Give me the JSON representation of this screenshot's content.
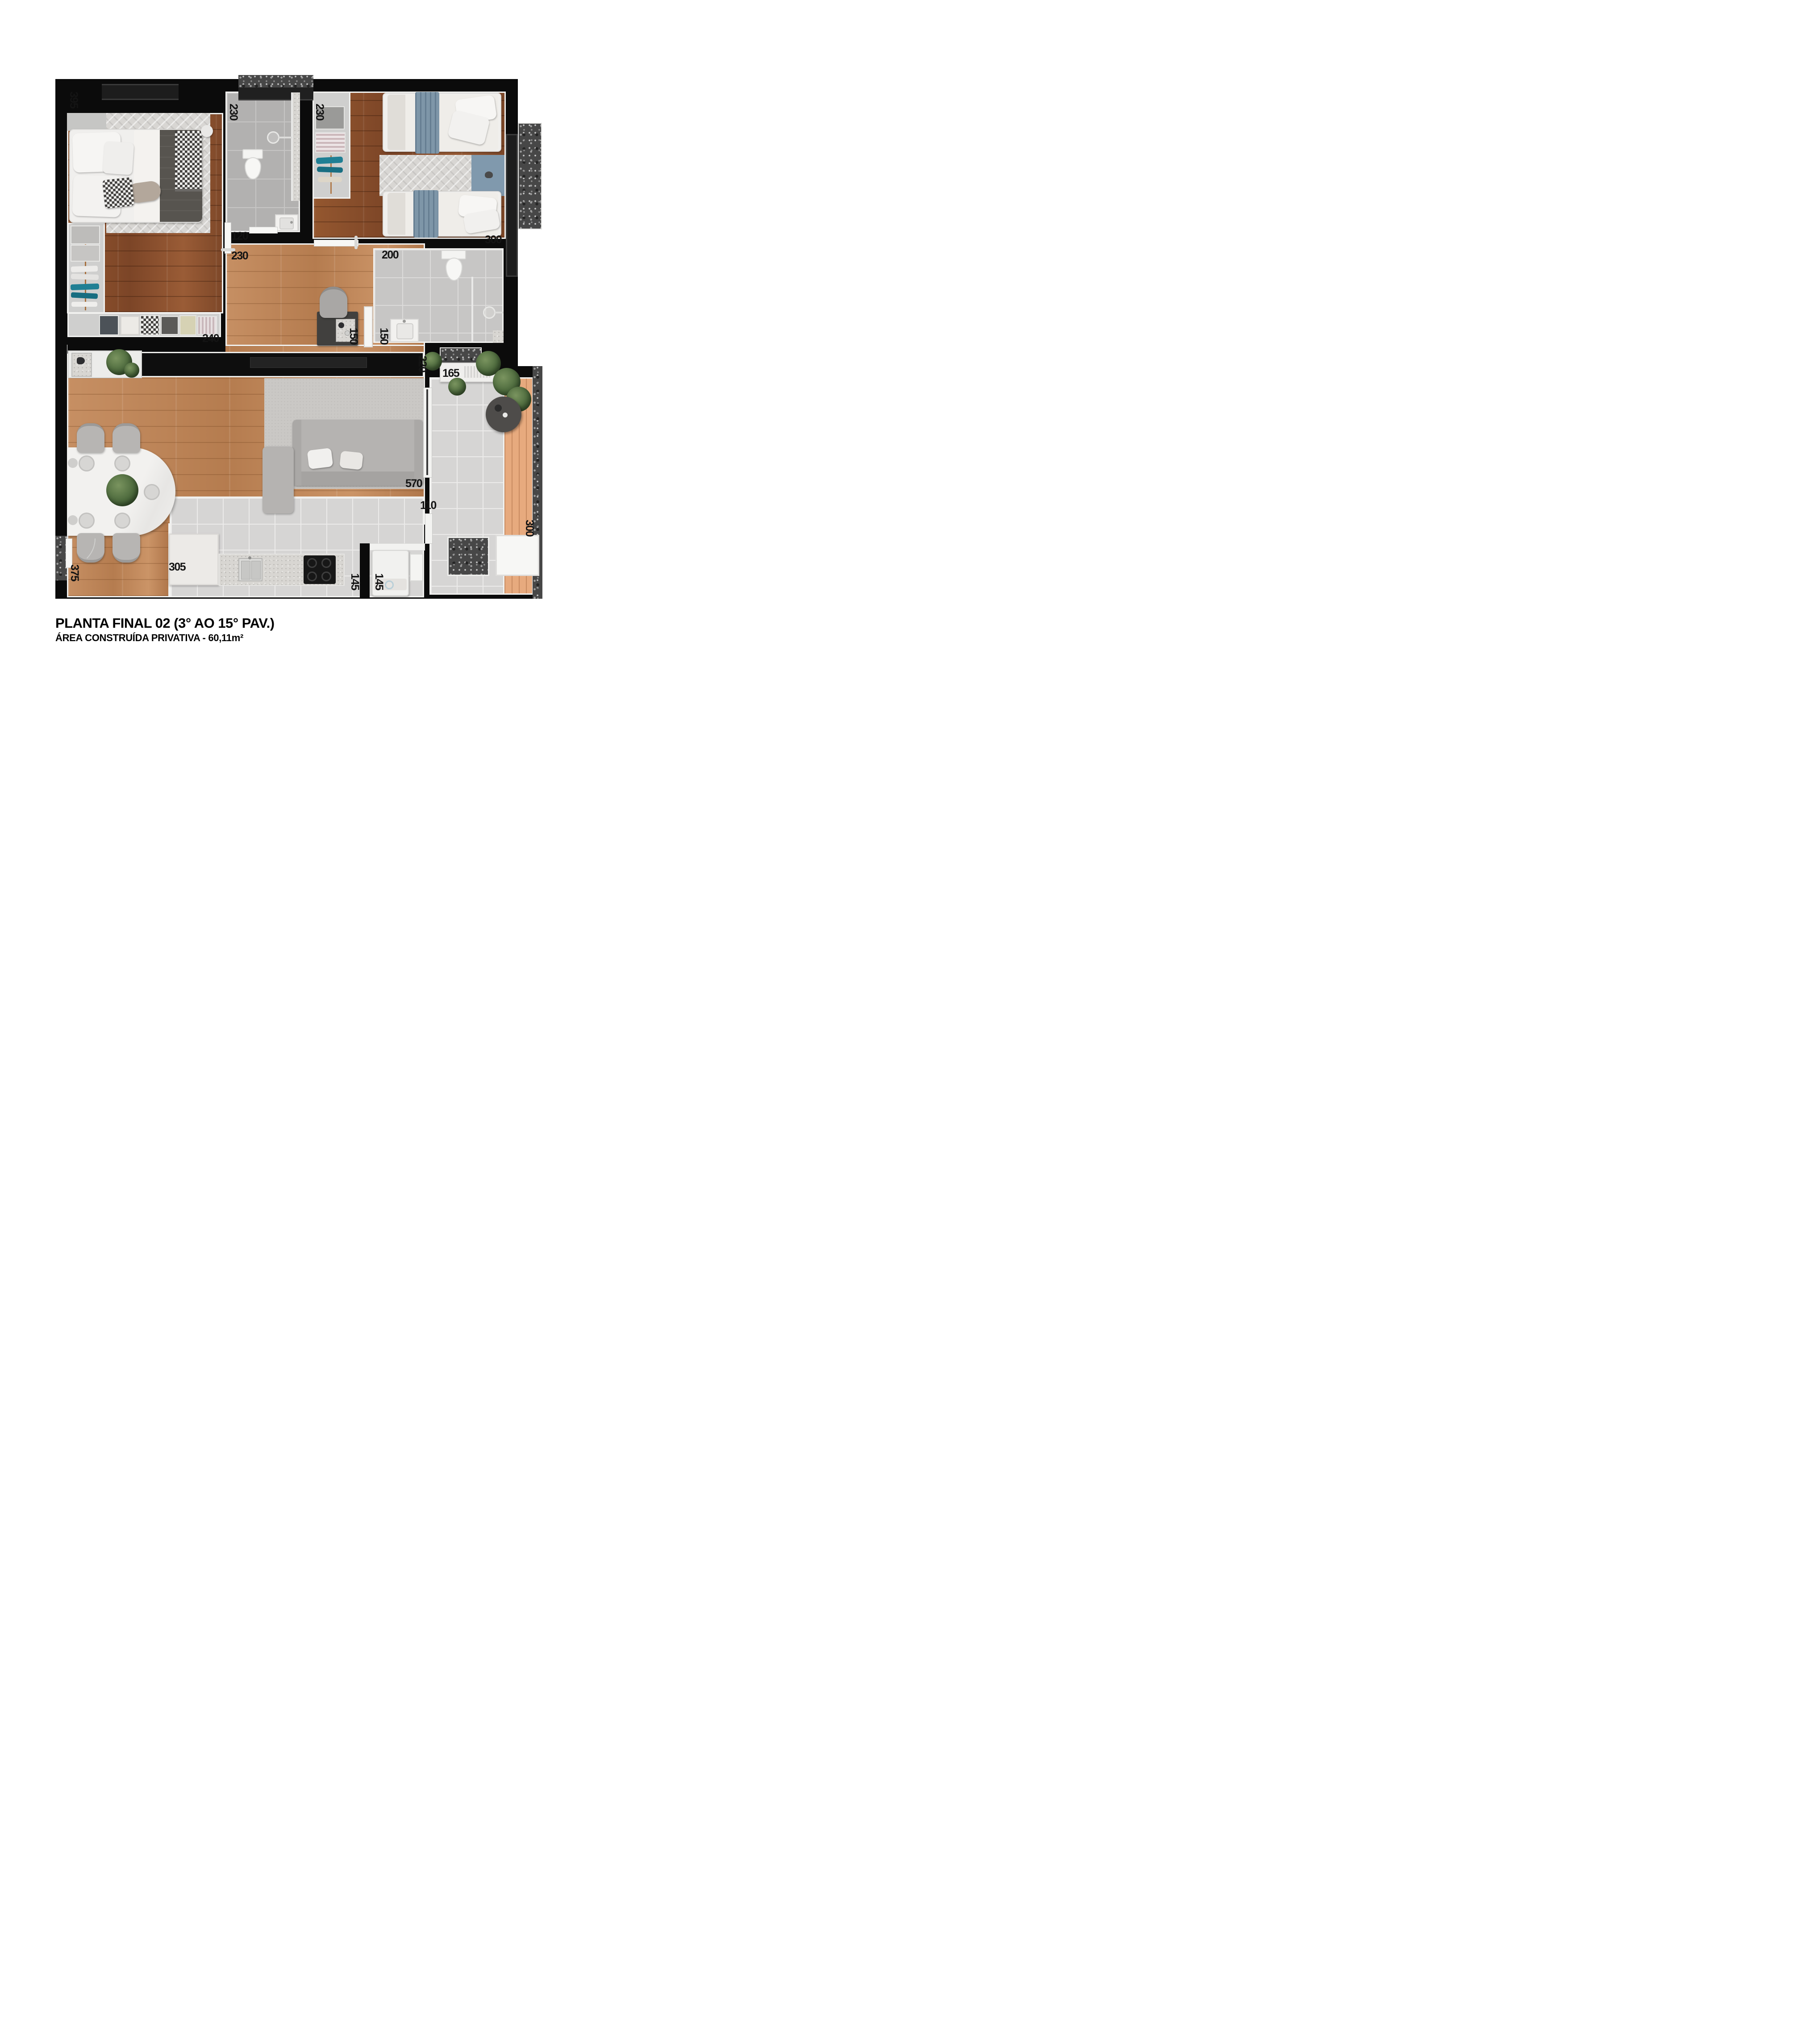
{
  "title": {
    "line1": "PLANTA FINAL 02 (3° AO 15° PAV.)",
    "line2": "ÁREA CONSTRUÍDA PRIVATIVA - 60,11m²"
  },
  "labels": [
    {
      "name": "master-bedroom-width",
      "value": "395",
      "orientation": "vertical"
    },
    {
      "name": "bathroom1-width",
      "value": "230",
      "orientation": "vertical"
    },
    {
      "name": "linen-closet-width",
      "value": "230",
      "orientation": "vertical"
    },
    {
      "name": "bathroom1-depth",
      "value": "120",
      "orientation": "horizontal"
    },
    {
      "name": "bedroom2-depth",
      "value": "300",
      "orientation": "horizontal"
    },
    {
      "name": "hall-width",
      "value": "230",
      "orientation": "horizontal"
    },
    {
      "name": "bathroom2-width",
      "value": "200",
      "orientation": "horizontal"
    },
    {
      "name": "wardrobe-width",
      "value": "240",
      "orientation": "horizontal"
    },
    {
      "name": "desk-depth",
      "value": "150",
      "orientation": "vertical"
    },
    {
      "name": "bathroom2-depth",
      "value": "150",
      "orientation": "vertical"
    },
    {
      "name": "living-balcony-wall",
      "value": "220",
      "orientation": "vertical"
    },
    {
      "name": "balcony-planter-width",
      "value": "165",
      "orientation": "horizontal"
    },
    {
      "name": "sofa-width",
      "value": "570",
      "orientation": "horizontal"
    },
    {
      "name": "balcony-opening-width",
      "value": "110",
      "orientation": "horizontal"
    },
    {
      "name": "kitchen-counter-width",
      "value": "305",
      "orientation": "horizontal"
    },
    {
      "name": "kitchen-depth",
      "value": "145",
      "orientation": "vertical"
    },
    {
      "name": "laundry-depth",
      "value": "145",
      "orientation": "vertical"
    },
    {
      "name": "dining-depth",
      "value": "375",
      "orientation": "vertical"
    },
    {
      "name": "balcony-depth",
      "value": "300",
      "orientation": "vertical"
    }
  ],
  "colors": {
    "wall": "#0b0b0b",
    "bedroom_wood": "#8a4f2f",
    "living_wood": "#c08a5e",
    "balcony_deck": "#e7aa7e",
    "tile": "#d6d5d4",
    "granite": "#474747",
    "accent_blue": "#7e96a8",
    "teal_clothes": "#1f7f94",
    "label_text": "#141414",
    "background": "#ffffff"
  }
}
